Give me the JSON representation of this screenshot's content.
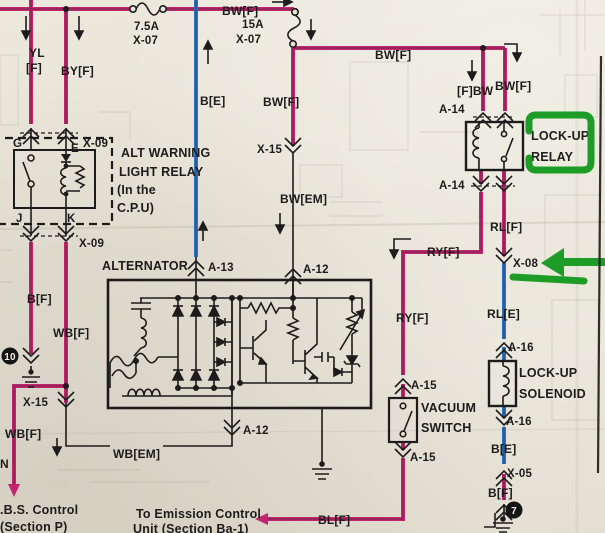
{
  "colors": {
    "wire_highlight_pink": "#c2256e",
    "wire_highlight_blue": "#2a72c2",
    "annotation_green": "#1e9c28",
    "ink": "#1c1c1c",
    "paper": "#e8e4d8"
  },
  "wire": {
    "bw_f": "BW[F]",
    "fbw": "[F]BW",
    "yl": "YL",
    "yl_f": "[F]",
    "by_f": "BY[F]",
    "b_e": "B[E]",
    "b_f": "B[F]",
    "wb_f": "WB[F]",
    "wb_em": "WB[EM]",
    "bw_em": "BW[EM]",
    "rl_f": "RL[F]",
    "rl_e": "RL[E]",
    "ry_f": "RY[F]",
    "bl_f": "BL[F]",
    "n_fragment": "N"
  },
  "connector": {
    "x07": "X-07",
    "x09": "X-09",
    "x15": "X-15",
    "x08": "X-08",
    "x05": "X-05",
    "a12": "A-12",
    "a13": "A-13",
    "a14": "A-14",
    "a15": "A-15",
    "a16": "A-16"
  },
  "fuse": {
    "f1_rating": "7.5A",
    "f2_rating": "15A"
  },
  "component": {
    "alt_warning_relay_l1": "ALT WARNING",
    "alt_warning_relay_l2": "LIGHT RELAY",
    "alt_warning_relay_l3": "(In the",
    "alt_warning_relay_l4": "C.P.U)",
    "alternator": "ALTERNATOR",
    "vacuum_switch_l1": "VACUUM",
    "vacuum_switch_l2": "SWITCH",
    "lockup_relay_l1": "LOCK-UP",
    "lockup_relay_l2": "RELAY",
    "lockup_solenoid_l1": "LOCK-UP",
    "lockup_solenoid_l2": "SOLENOID"
  },
  "terminal": {
    "g": "G",
    "e": "E",
    "j": "J",
    "k": "K"
  },
  "destination": {
    "abs_l1": ".B.S. Control",
    "abs_l2": "(Section P)",
    "emission_l1": "To Emission Control",
    "emission_l2": "Unit (Section Ba-1)"
  },
  "ground": {
    "left_id": "10",
    "right_id": "7"
  }
}
